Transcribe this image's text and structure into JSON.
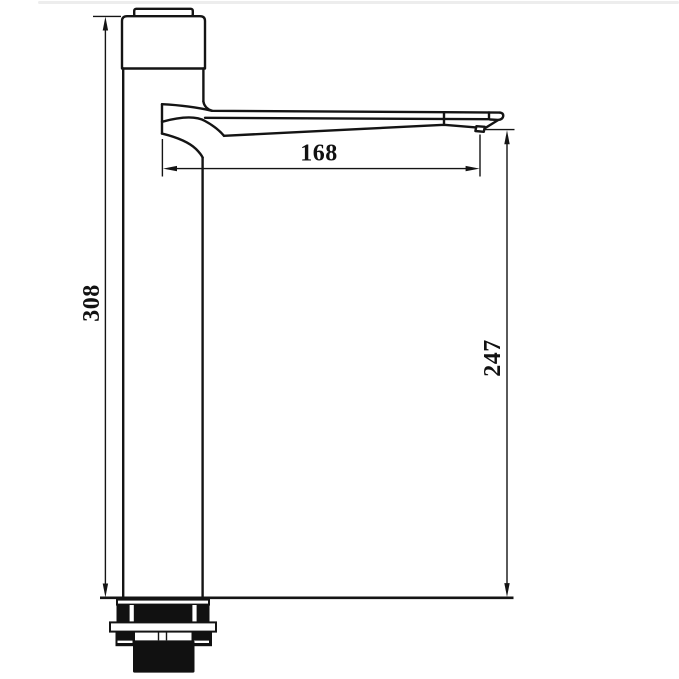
{
  "page": {
    "background": "#ffffff"
  },
  "drawing": {
    "kind": "faucet-dimension-diagram",
    "subject": "tall-single-lever-basin-mixer-side-elevation",
    "line_color": "#141414",
    "hardware_fill_color": "#111111",
    "dimensions": {
      "overall_height": {
        "value": "308",
        "orientation": "vertical",
        "position": "left-of-body"
      },
      "spout_reach": {
        "value": "168",
        "orientation": "horizontal",
        "position": "under-spout"
      },
      "spout_outlet_height": {
        "value": "247",
        "orientation": "vertical",
        "position": "right-of-spout-tip"
      }
    }
  }
}
